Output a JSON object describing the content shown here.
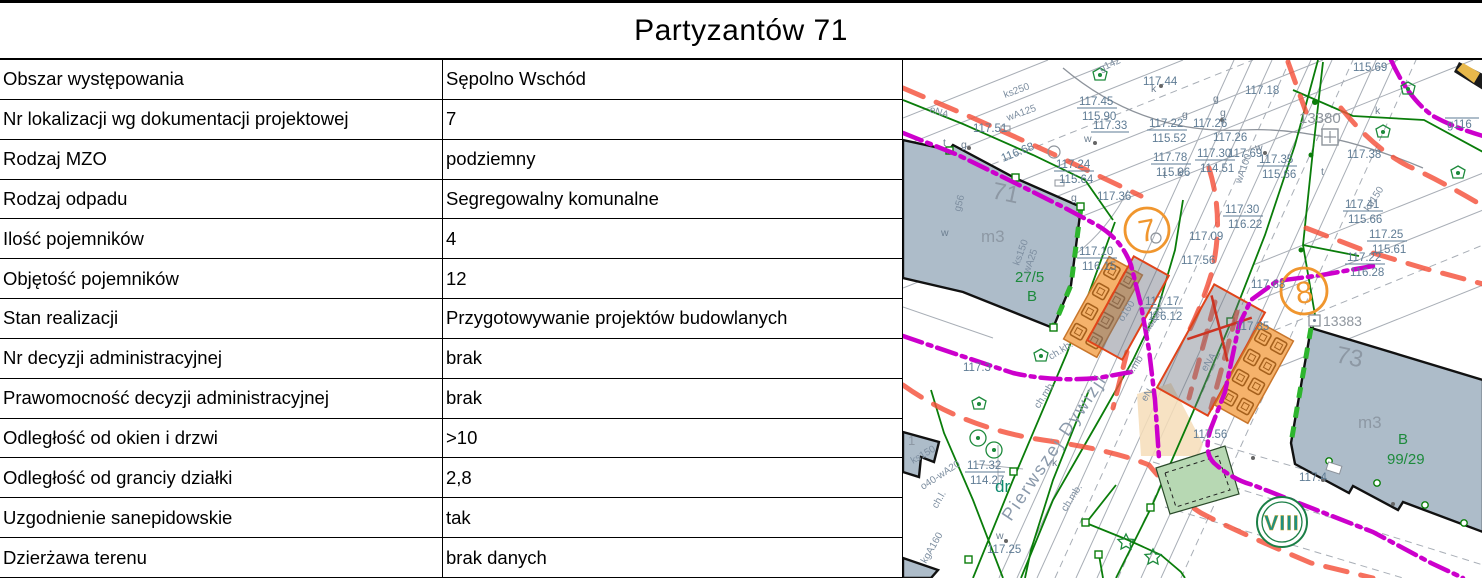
{
  "title": "Partyzantów 71",
  "table": {
    "rows": [
      {
        "label": "Obszar występowania",
        "value": "Sępolno Wschód"
      },
      {
        "label": "Nr lokalizacji wg dokumentacji projektowej",
        "value": "7"
      },
      {
        "label": "Rodzaj MZO",
        "value": "podziemny"
      },
      {
        "label": "Rodzaj odpadu",
        "value": "Segregowalny komunalne"
      },
      {
        "label": "Ilość pojemników",
        "value": "4"
      },
      {
        "label": "Objętość pojemników",
        "value": "12"
      },
      {
        "label": "Stan realizacji",
        "value": "Przygotowywanie projektów budowlanych"
      },
      {
        "label": "Nr decyzji administracyjnej",
        "value": "brak"
      },
      {
        "label": "Prawomocność decyzji administracyjnej",
        "value": "brak"
      },
      {
        "label": "Odległość od okien i drzwi",
        "value": ">10"
      },
      {
        "label": "Odległość od granciy działki",
        "value": "2,8"
      },
      {
        "label": "Uzgodnienie sanepidowskie",
        "value": "tak"
      },
      {
        "label": "Dzierżawa terenu",
        "value": "brak danych"
      }
    ]
  },
  "map": {
    "street": "Pierwszej Dywizji",
    "dr": "dr",
    "markers": {
      "m7": "7",
      "m8": "8",
      "zone": "VIII"
    },
    "ids": [
      "13380",
      "13383"
    ],
    "buildings": {
      "b71": {
        "num": "71",
        "type": "m3",
        "parcel": "27/5",
        "cls": "B"
      },
      "b73": {
        "num": "73",
        "type": "m3",
        "cls": "B",
        "parcel": "99/29"
      },
      "small": "1"
    },
    "elev": [
      "117.44",
      "117.33",
      "117.51",
      "116.68",
      "117.26",
      "117.26",
      "117.18",
      "115.69",
      "117.69",
      "117.38",
      "117.36",
      "117.09",
      "117.56",
      "117.68",
      "117.3",
      "117.56",
      "117.4",
      "117.25",
      "g116",
      "117.35"
    ],
    "frac": [
      [
        "117.45",
        "115.90"
      ],
      [
        "117.22",
        "115.52"
      ],
      [
        "117.78",
        "115.96"
      ],
      [
        "117.30",
        "114.51"
      ],
      [
        "117.24",
        "115.64"
      ],
      [
        "117.35",
        "115.66"
      ],
      [
        "117.30",
        "116.22"
      ],
      [
        "117.41",
        "115.66"
      ],
      [
        "117.25",
        "115.61"
      ],
      [
        "117.22",
        "116.28"
      ],
      [
        "117.10",
        "116.15"
      ],
      [
        "117.17",
        "116.12"
      ],
      [
        "117.32",
        "114.27"
      ]
    ],
    "util": [
      "ks250",
      "wA125",
      "g142",
      "eNA",
      "kd150",
      "wA100",
      "ks250",
      "l.mb",
      "eN",
      "eNA",
      "o160",
      "ch.kb.",
      "ch.mb.",
      "ch.mb.",
      "ks150",
      "o40-wA20",
      "kgA160",
      "ch.l.",
      "g56",
      "ks150",
      "wA25"
    ],
    "letters": [
      "k",
      "g",
      "g",
      "g",
      "w",
      "w",
      "t",
      "k",
      "k",
      "t",
      "w",
      "g",
      "t",
      "w",
      "k",
      "g"
    ],
    "colors": {
      "magenta": "#cc00cc",
      "red_dashed": "#f4503a",
      "green_line": "#0a7d0a",
      "orange_marker": "#f0962e",
      "building_fill": "#adbcc9",
      "container_fill": "#f5b26b",
      "zone_green": "#1f9080"
    }
  }
}
